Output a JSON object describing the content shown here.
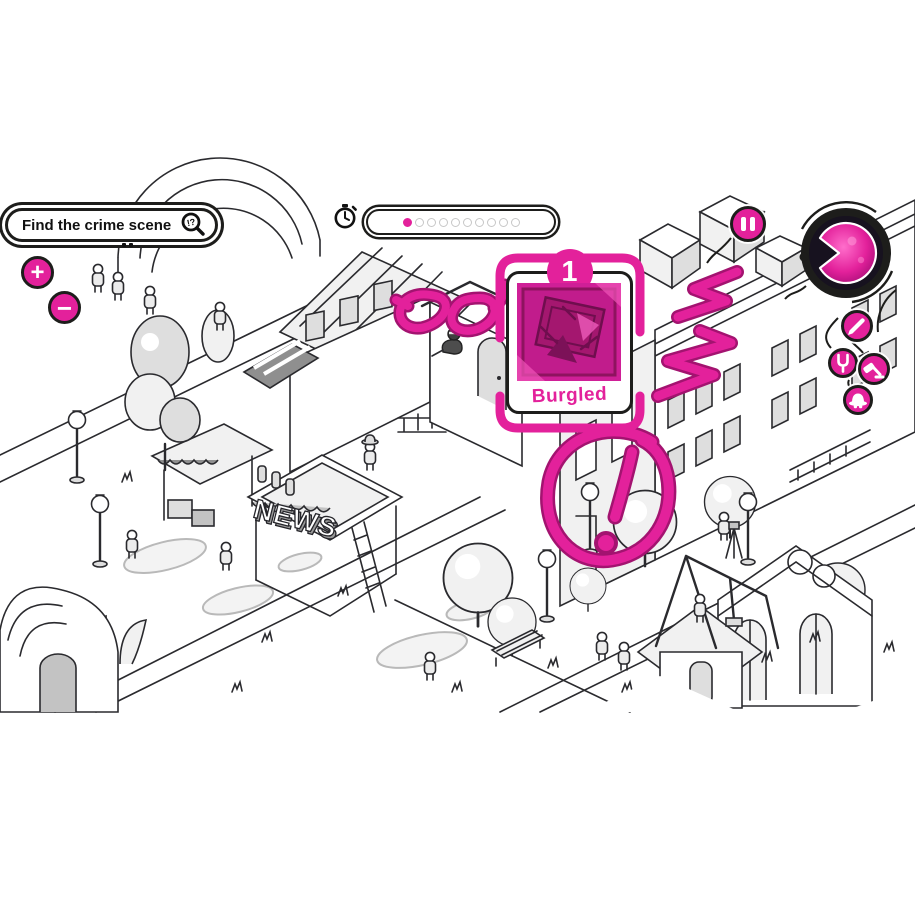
{
  "hud": {
    "objective": {
      "label": "Find the crime scene",
      "magnifier_hint": "!?"
    },
    "zoom": {
      "in_label": "+",
      "out_label": "−"
    },
    "progress": {
      "filled": 1,
      "total": 10
    },
    "card": {
      "number": "1",
      "label": "Burgled"
    },
    "tools": {
      "pencil": "pencil",
      "tuning_fork": "tuning-fork",
      "gavel": "gavel",
      "detective_hat": "detective-hat"
    }
  },
  "scene": {
    "news_sign": "NEWS"
  },
  "annotations": {
    "scribbles": [
      "mask",
      "lightning",
      "circled-exclamation"
    ]
  },
  "colors": {
    "pink": "#e3219b",
    "pink_dark": "#a31370",
    "ink": "#1d1d1b",
    "card_image_bg": "#cf1f97"
  }
}
